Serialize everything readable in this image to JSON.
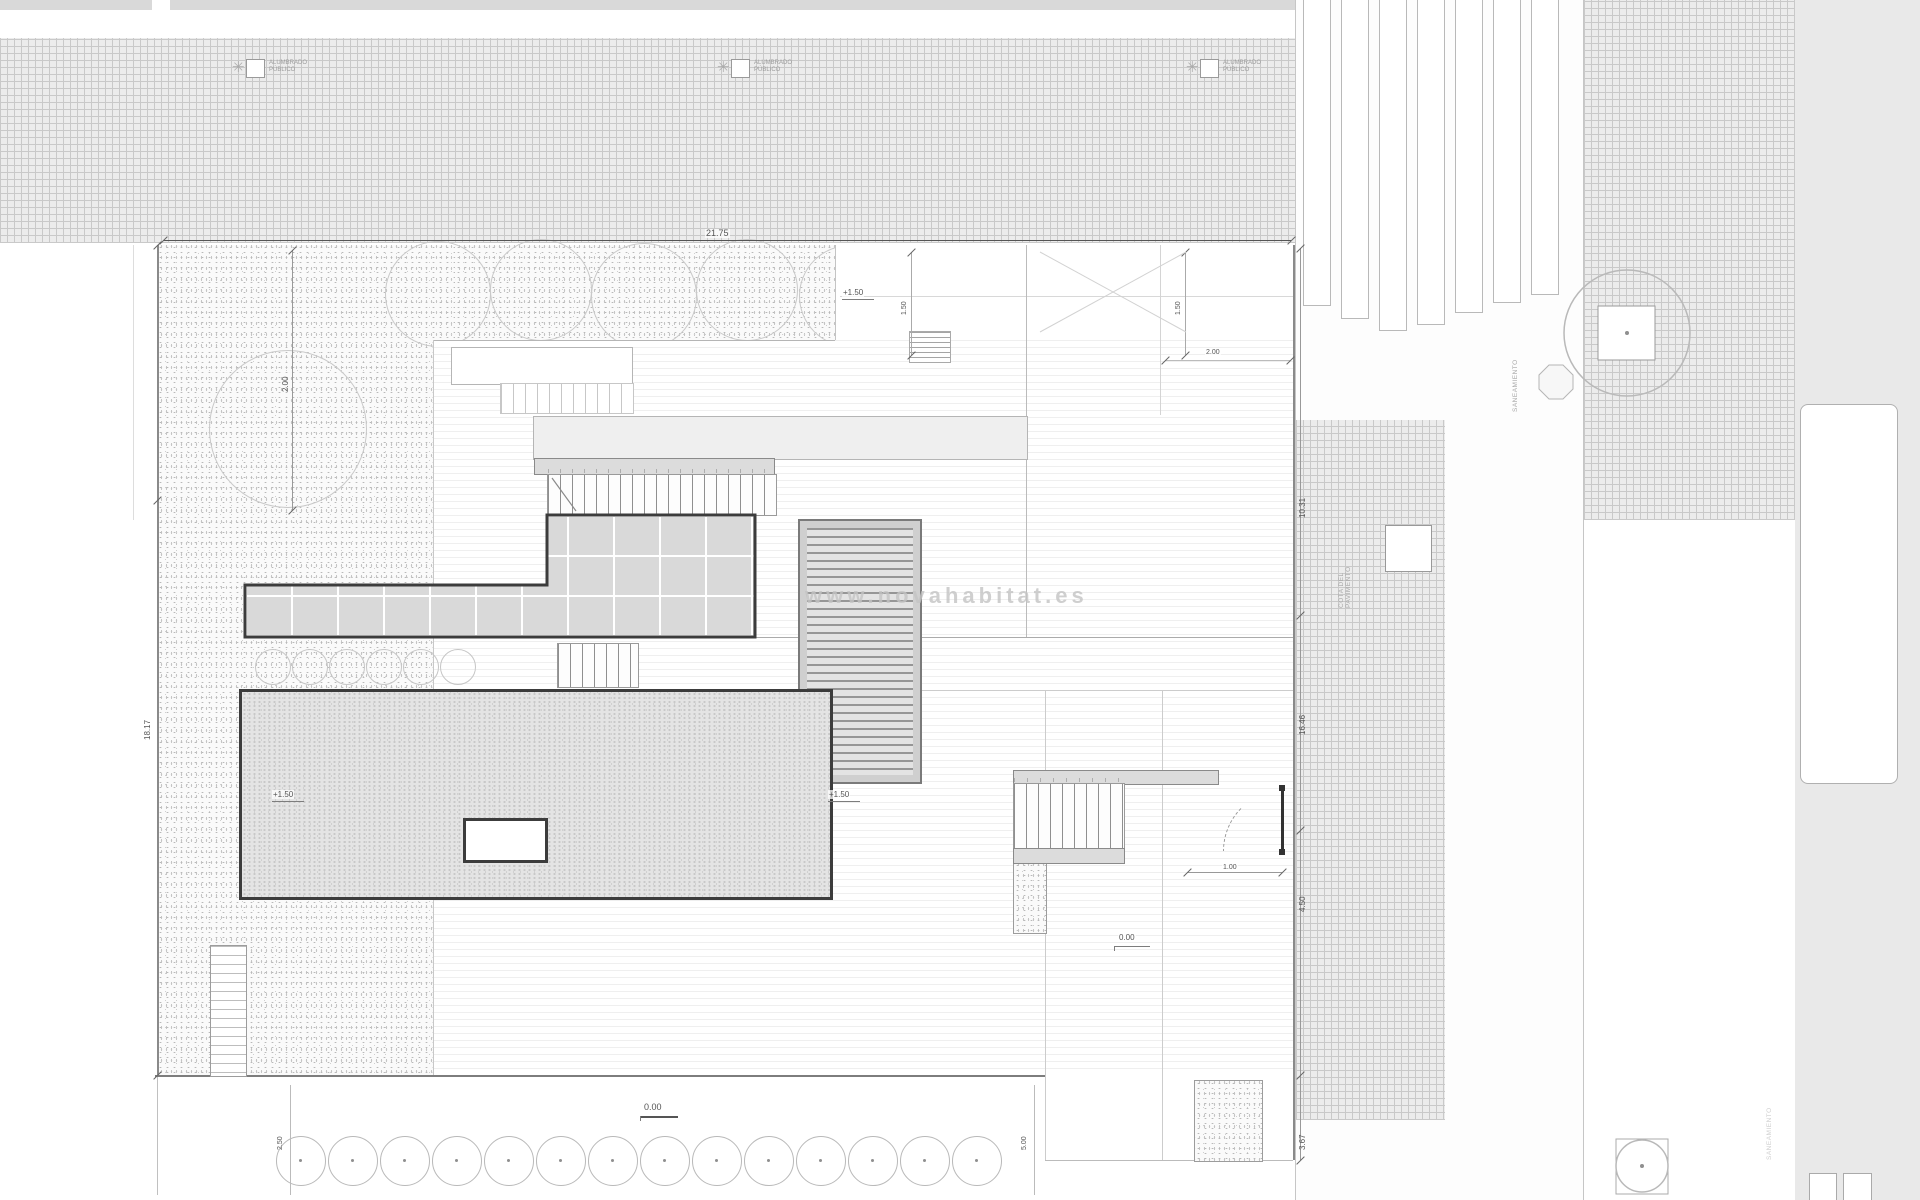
{
  "watermark": "www.novahabitat.es",
  "labels": {
    "street_lamp": "ALUMBRADO PÚBLICO",
    "sewer_north": "SANEAMIENTO",
    "sewer_south": "SANEAMIENTO",
    "pavement_note_line1": "COTA DEL",
    "pavement_note_line2": "PAVIMENTO"
  },
  "levels": {
    "terrace_top": "+1.50",
    "garden_west": "+1.50",
    "walkway_mid": "+1.50",
    "drive": "0.00",
    "street_south": "0.00"
  },
  "dimensions": {
    "north_width": "21.75",
    "west_height": "18.17",
    "west_offset": "2.00",
    "north_stub_a": "1.50",
    "north_stub_b": "1.50",
    "entry_offset": "2.00",
    "gate_width": "1.00",
    "east_seg_1": "10.31",
    "east_seg_2": "16.46",
    "east_seg_3": "4.50",
    "east_seg_4": "3.67",
    "south_stub_left": "2.50",
    "south_stub_right": "5.00"
  },
  "counts": {
    "street_lamps": 3,
    "crosswalk_stripes": 7,
    "south_trees": 14,
    "shrub_row": 6,
    "main_stair_treads": 18,
    "upper_stair_treads": 11,
    "mid_stair_treads": 8,
    "south_stair_treads": 8,
    "side_stair_treads": 6
  }
}
